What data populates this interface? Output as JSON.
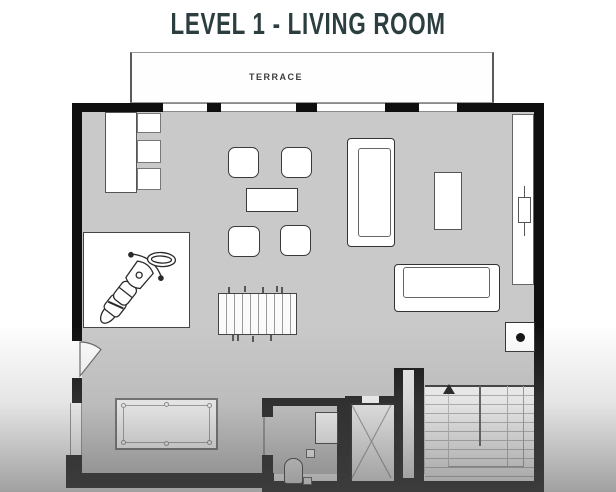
{
  "header": {
    "title": "LEVEL 1 - LIVING ROOM"
  },
  "plan": {
    "terrace_label": "TERRACE",
    "colors": {
      "title": "#2c3e40",
      "wall": "#0f0f0f",
      "floor": "#c9c9c9",
      "furniture_fill": "#ffffff",
      "outline": "#555555"
    },
    "rooms": [
      "terrace",
      "living-room",
      "bathroom",
      "elevator",
      "staircase"
    ],
    "furniture_icons": [
      "desk",
      "desk-stool",
      "armchair",
      "coffee-table",
      "large-sofa",
      "console-table",
      "wardrobe",
      "motorcycle",
      "foosball-table",
      "small-sofa",
      "lamp-table",
      "pool-table",
      "sink",
      "toilet",
      "door-swing",
      "stairs-direction-arrow",
      "elevator-cross"
    ]
  }
}
